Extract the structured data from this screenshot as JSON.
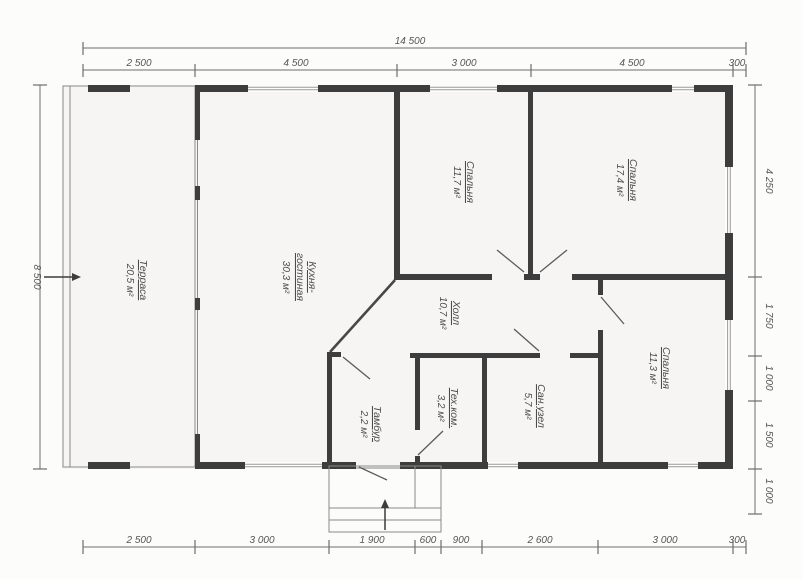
{
  "plan": {
    "type_label": "floor-plan",
    "colors": {
      "wall": "#3d3d3d",
      "thin_line": "#8a8a8a",
      "text": "#4c4c4c",
      "paper": "#fcfcfb",
      "floor": "#f6f5f3"
    }
  },
  "dimensions": {
    "top": {
      "total": "14 500",
      "segments": [
        "2 500",
        "4 500",
        "3 000",
        "4 500",
        "300"
      ]
    },
    "bottom": {
      "segments": [
        "2 500",
        "3 000",
        "1 900",
        "600",
        "900",
        "2 600",
        "3 000",
        "300"
      ]
    },
    "left": {
      "total": "8 500"
    },
    "right": {
      "segments": [
        "4 250",
        "1 750",
        "1 000",
        "1 500",
        "1 000"
      ]
    }
  },
  "rooms": [
    {
      "name": "Терраса",
      "area": "20,5 м²"
    },
    {
      "name": "Кухня-",
      "name2": "гостиная",
      "area": "30,3 м²"
    },
    {
      "name": "Спальня",
      "area": "11,7 м²"
    },
    {
      "name": "Спальня",
      "area": "17,4 м²"
    },
    {
      "name": "Холл",
      "area": "10,7 м²"
    },
    {
      "name": "Спальня",
      "area": "11,3 м²"
    },
    {
      "name": "Сан.узел",
      "area": "5,7 м²"
    },
    {
      "name": "Тех.ком.",
      "area": "3,2 м²"
    },
    {
      "name": "Тамбур",
      "area": "2,2 м²"
    }
  ]
}
